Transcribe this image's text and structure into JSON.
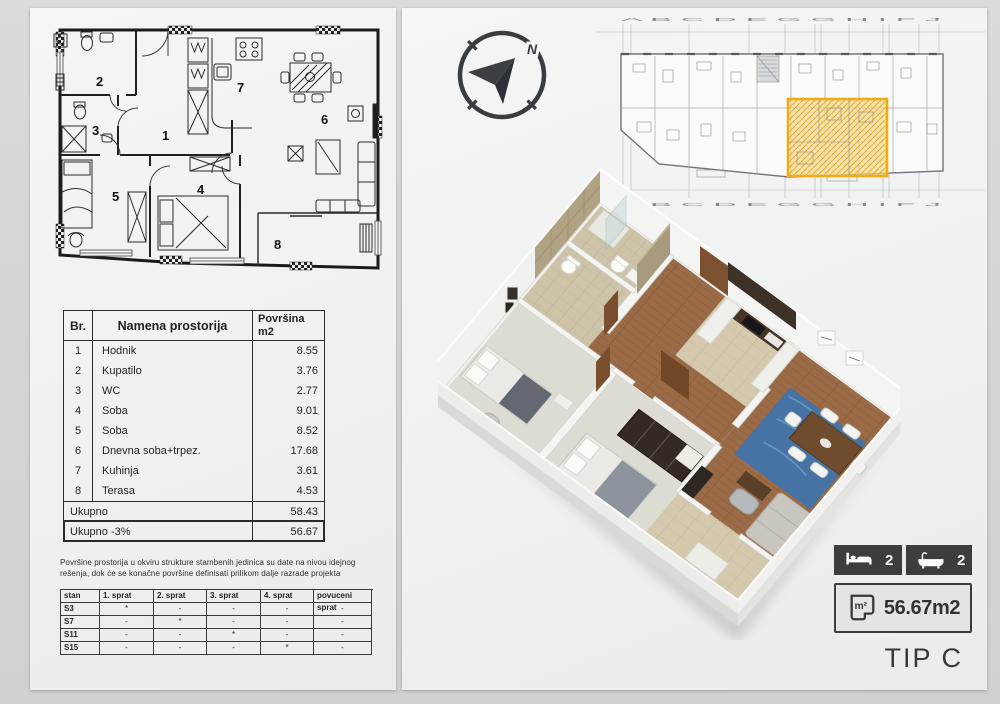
{
  "page": {
    "tip": "TIP C"
  },
  "compass": {
    "north": "N"
  },
  "plan2d": {
    "rooms": [
      "1",
      "2",
      "3",
      "4",
      "5",
      "6",
      "7",
      "8"
    ]
  },
  "siteplan": {
    "letters": "A B   C   D   E   G G   H   I F   J"
  },
  "rooms_table": {
    "header_br": "Br.",
    "header_name": "Namena prostorija",
    "header_area1": "Površina",
    "header_area2": "m2",
    "rows": [
      {
        "br": "1",
        "name": "Hodnik",
        "area": "8.55"
      },
      {
        "br": "2",
        "name": "Kupatilo",
        "area": "3.76"
      },
      {
        "br": "3",
        "name": "WC",
        "area": "2.77"
      },
      {
        "br": "4",
        "name": "Soba",
        "area": "9.01"
      },
      {
        "br": "5",
        "name": "Soba",
        "area": "8.52"
      },
      {
        "br": "6",
        "name": "Dnevna soba+trpez.",
        "area": "17.68"
      },
      {
        "br": "7",
        "name": "Kuhinja",
        "area": "3.61"
      },
      {
        "br": "8",
        "name": "Terasa",
        "area": "4.53"
      }
    ],
    "total_label": "Ukupno",
    "total_value": "58.43",
    "total2_label": "Ukupno  -3%",
    "total2_value": "56.67"
  },
  "note": "Površine prostorija u okviru strukture stambenih jedinica su date na nivou idejnog rešenja, dok će se konačne površine definisati prilikom dalje razrade projekta",
  "floors_table": {
    "headers": [
      "stan",
      "1. sprat",
      "2. sprat",
      "3. sprat",
      "4. sprat",
      "povuceni sprat"
    ],
    "rows": [
      {
        "cells": [
          "S3",
          "*",
          "-",
          "-",
          "-",
          "-"
        ]
      },
      {
        "cells": [
          "S7",
          "-",
          "*",
          "-",
          "-",
          "-"
        ]
      },
      {
        "cells": [
          "S11",
          "-",
          "-",
          "*",
          "-",
          "-"
        ]
      },
      {
        "cells": [
          "S15",
          "-",
          "-",
          "-",
          "*",
          "-"
        ]
      }
    ]
  },
  "badges": {
    "beds": "2",
    "baths": "2",
    "area_icon": "m²",
    "area": "56.67m2"
  },
  "colors": {
    "accent_yellow": "#EFAD15",
    "dark": "#3B3E40"
  }
}
